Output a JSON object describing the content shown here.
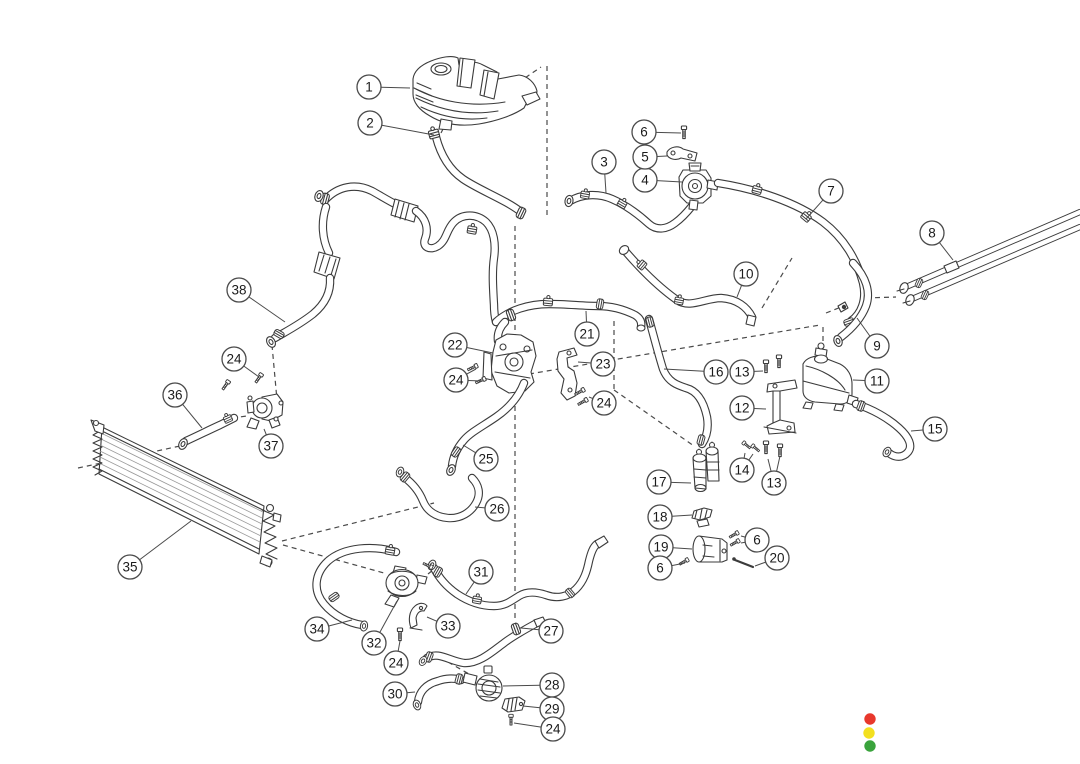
{
  "diagram": {
    "kind": "exploded-parts-diagram",
    "subject": "engine cooling system hoses, radiator and reservoirs",
    "background": "#ffffff",
    "line_color": "#3b3b3b",
    "callout_style": {
      "radius": 12,
      "font_size": 13.5,
      "circle_fill": "#ffffff",
      "circle_stroke": "#4a4a4a",
      "text_color": "#1b1b1b",
      "leader_color": "#4a4a4a"
    },
    "callouts": [
      {
        "number": "1",
        "x": 369,
        "y": 87,
        "leaders": [
          [
            410,
            88
          ]
        ]
      },
      {
        "number": "2",
        "x": 370,
        "y": 123,
        "leaders": [
          [
            434,
            135
          ]
        ]
      },
      {
        "number": "3",
        "x": 604,
        "y": 162,
        "leaders": [
          [
            606,
            193
          ]
        ]
      },
      {
        "number": "4",
        "x": 645,
        "y": 180,
        "leaders": [
          [
            682,
            182
          ]
        ]
      },
      {
        "number": "5",
        "x": 645,
        "y": 157,
        "leaders": [
          [
            667,
            156
          ]
        ]
      },
      {
        "number": "6",
        "x": 644,
        "y": 132,
        "leaders": [
          [
            681,
            133
          ]
        ]
      },
      {
        "number": "7",
        "x": 831,
        "y": 191,
        "leaders": [
          [
            806,
            219
          ]
        ]
      },
      {
        "number": "8",
        "x": 932,
        "y": 233,
        "leaders": [
          [
            953,
            260
          ]
        ]
      },
      {
        "number": "9",
        "x": 877,
        "y": 346,
        "leaders": [
          [
            857,
            318
          ]
        ]
      },
      {
        "number": "10",
        "x": 746,
        "y": 274,
        "leaders": [
          [
            737,
            297
          ]
        ]
      },
      {
        "number": "11",
        "x": 877,
        "y": 381,
        "leaders": [
          [
            853,
            380
          ]
        ]
      },
      {
        "number": "12",
        "x": 742,
        "y": 408,
        "leaders": [
          [
            766,
            409
          ]
        ]
      },
      {
        "number": "13",
        "x": 742,
        "y": 372,
        "leaders": [
          [
            763,
            371
          ]
        ]
      },
      {
        "number": "13",
        "x": 774,
        "y": 483,
        "leaders": [
          [
            768,
            459
          ],
          [
            780,
            456
          ]
        ]
      },
      {
        "number": "14",
        "x": 742,
        "y": 470,
        "leaders": [
          [
            745,
            453
          ],
          [
            753,
            454
          ]
        ]
      },
      {
        "number": "15",
        "x": 935,
        "y": 429,
        "leaders": [
          [
            911,
            431
          ]
        ]
      },
      {
        "number": "16",
        "x": 716,
        "y": 372,
        "leaders": [
          [
            664,
            369
          ]
        ]
      },
      {
        "number": "17",
        "x": 659,
        "y": 482,
        "leaders": [
          [
            691,
            483
          ]
        ]
      },
      {
        "number": "18",
        "x": 660,
        "y": 517,
        "leaders": [
          [
            692,
            515
          ]
        ]
      },
      {
        "number": "19",
        "x": 661,
        "y": 547,
        "leaders": [
          [
            692,
            549
          ]
        ]
      },
      {
        "number": "6",
        "x": 757,
        "y": 540,
        "leaders": [
          [
            741,
            536
          ],
          [
            741,
            543
          ]
        ]
      },
      {
        "number": "20",
        "x": 777,
        "y": 558,
        "leaders": [
          [
            755,
            566
          ]
        ]
      },
      {
        "number": "6",
        "x": 660,
        "y": 568,
        "leaders": [
          [
            685,
            563
          ]
        ]
      },
      {
        "number": "21",
        "x": 587,
        "y": 334,
        "leaders": [
          [
            586,
            311
          ]
        ]
      },
      {
        "number": "22",
        "x": 455,
        "y": 345,
        "leaders": [
          [
            493,
            353
          ]
        ]
      },
      {
        "number": "23",
        "x": 603,
        "y": 364,
        "leaders": [
          [
            578,
            362
          ]
        ]
      },
      {
        "number": "24",
        "x": 456,
        "y": 380,
        "leaders": [
          [
            476,
            369
          ],
          [
            483,
            381
          ]
        ]
      },
      {
        "number": "24",
        "x": 604,
        "y": 403,
        "leaders": [
          [
            589,
            397
          ]
        ]
      },
      {
        "number": "24",
        "x": 234,
        "y": 359,
        "leaders": [
          [
            259,
            377
          ]
        ]
      },
      {
        "number": "25",
        "x": 486,
        "y": 459,
        "leaders": [
          [
            463,
            445
          ]
        ]
      },
      {
        "number": "26",
        "x": 497,
        "y": 509,
        "leaders": [
          [
            475,
            507
          ]
        ]
      },
      {
        "number": "27",
        "x": 551,
        "y": 631,
        "leaders": [
          [
            521,
            628
          ]
        ]
      },
      {
        "number": "28",
        "x": 552,
        "y": 685,
        "leaders": [
          [
            503,
            686
          ]
        ]
      },
      {
        "number": "29",
        "x": 552,
        "y": 709,
        "leaders": [
          [
            523,
            706
          ]
        ]
      },
      {
        "number": "24",
        "x": 553,
        "y": 729,
        "leaders": [
          [
            514,
            723
          ]
        ]
      },
      {
        "number": "30",
        "x": 395,
        "y": 694,
        "leaders": [
          [
            415,
            692
          ]
        ]
      },
      {
        "number": "31",
        "x": 481,
        "y": 572,
        "leaders": [
          [
            466,
            594
          ]
        ]
      },
      {
        "number": "32",
        "x": 374,
        "y": 643,
        "leaders": [
          [
            397,
            601
          ]
        ]
      },
      {
        "number": "33",
        "x": 448,
        "y": 626,
        "leaders": [
          [
            427,
            617
          ]
        ]
      },
      {
        "number": "24",
        "x": 396,
        "y": 663,
        "leaders": [
          [
            400,
            641
          ]
        ]
      },
      {
        "number": "34",
        "x": 317,
        "y": 629,
        "leaders": [
          [
            352,
            620
          ]
        ]
      },
      {
        "number": "35",
        "x": 130,
        "y": 567,
        "leaders": [
          [
            191,
            521
          ]
        ]
      },
      {
        "number": "36",
        "x": 175,
        "y": 395,
        "leaders": [
          [
            202,
            428
          ]
        ]
      },
      {
        "number": "37",
        "x": 271,
        "y": 446,
        "leaders": [
          [
            264,
            429
          ]
        ]
      },
      {
        "number": "38",
        "x": 239,
        "y": 290,
        "leaders": [
          [
            285,
            322
          ]
        ]
      }
    ],
    "status_dots": [
      {
        "name": "red-dot",
        "color": "#e8382c",
        "x": 870,
        "y": 719,
        "r": 5.7
      },
      {
        "name": "yellow-dot",
        "color": "#f3e01f",
        "x": 869,
        "y": 733,
        "r": 5.7
      },
      {
        "name": "green-dot",
        "color": "#3aa33c",
        "x": 870,
        "y": 746,
        "r": 5.7
      }
    ]
  }
}
